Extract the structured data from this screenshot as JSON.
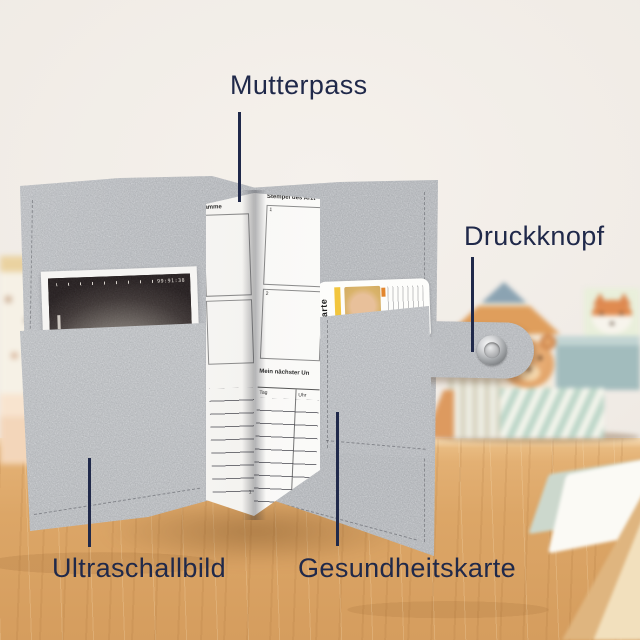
{
  "annotations": {
    "top": "Mutterpass",
    "right": "Druckknopf",
    "bottom_left": "Ultraschallbild",
    "bottom_right": "Gesundheitskarte"
  },
  "booklet": {
    "left_page": {
      "header_partial": "bamme",
      "page_number": "1"
    },
    "right_page": {
      "header": "Stempel des Arzt",
      "box_labels": [
        "1",
        "2"
      ],
      "appointment_heading": "Mein nächster Un",
      "table_columns": [
        "Tag",
        "Uhr"
      ]
    }
  },
  "ultrasound": {
    "display_text": "99:91:38"
  },
  "health_card": {
    "vertical_label": "karte"
  },
  "colors": {
    "annotation_navy": "#20294a",
    "felt_gray": "#b4b7ba",
    "wood_tan": "#dda76a",
    "wall_cream": "#f1ede8"
  }
}
